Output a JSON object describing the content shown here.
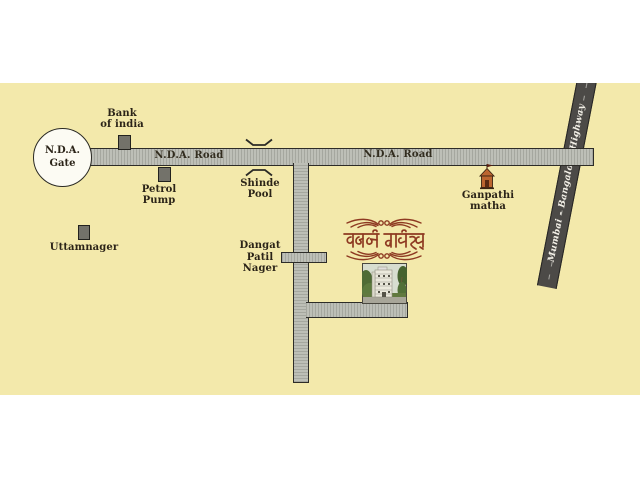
{
  "map": {
    "gate": {
      "line1": "N.D.A.",
      "line2": "Gate"
    },
    "roads": {
      "nda_label_west": "N.D.A. Road",
      "nda_label_east": "N.D.A. Road",
      "highway_label": "Mumbai - Bangalore Highway"
    },
    "pois": {
      "bank": {
        "line1": "Bank",
        "line2": "of india"
      },
      "petrol": {
        "line1": "Petrol",
        "line2": "Pump"
      },
      "shinde": {
        "line1": "Shinde",
        "line2": "Pool"
      },
      "uttamnager": {
        "label": "Uttamnager"
      },
      "dangat": {
        "line1": "Dangat",
        "line2": "Patil",
        "line3": "Nager"
      },
      "ganpathi": {
        "line1": "Ganpathi",
        "line2": "matha"
      }
    },
    "logo": {
      "text": "समर्थ हाईट्स्"
    },
    "colors": {
      "page_bg": "#ffffff",
      "map_bg": "#f3e9ab",
      "road_fill": "#bdbfb7",
      "road_border": "#2d2c28",
      "highway_fill": "#4c4a47",
      "marker_fill": "#73726a",
      "label_text": "#2b2418",
      "logo_maroon": "#8e3a22",
      "temple_orange": "#bc6530"
    }
  }
}
